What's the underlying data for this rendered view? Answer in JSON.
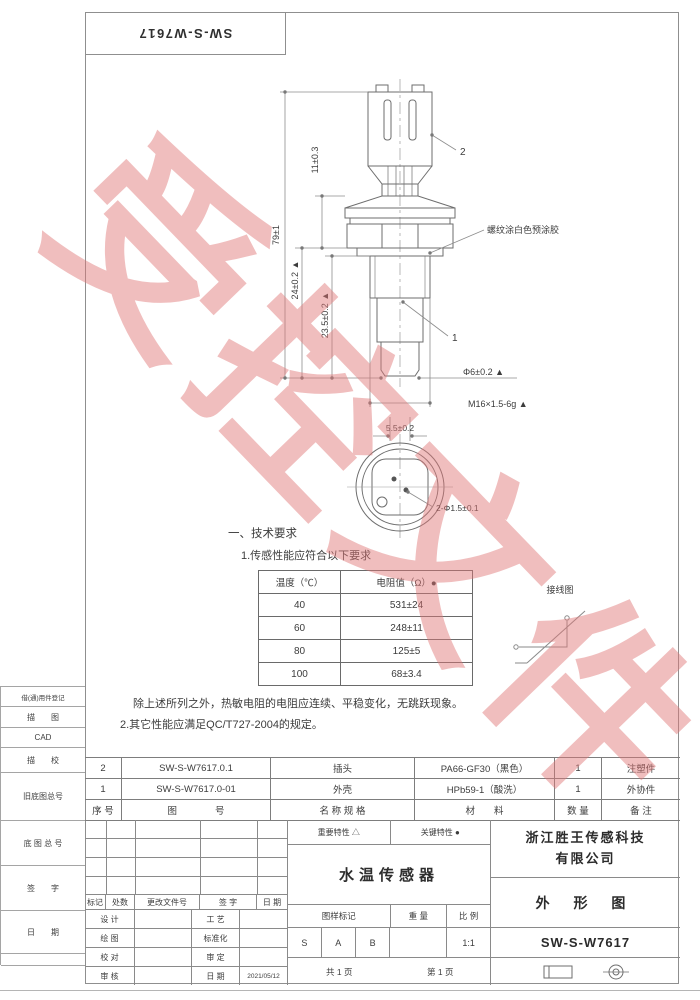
{
  "sheet": {
    "doc_number_top": "SW-S-W7617"
  },
  "watermark": {
    "text": "受控文件"
  },
  "drawing": {
    "callout_connector": "2",
    "callout_body": "1",
    "thread_note": "螺纹涂白色预涂胶",
    "wiring_label": "接线图",
    "dims": {
      "overall_length": "79±1",
      "connector_height": "11±0.3",
      "body_length": "24±0.2 ▲",
      "thread_length": "23.5±0.2 ▲",
      "probe_diameter": "Φ6±0.2 ▲",
      "thread_spec": "M16×1.5-6g ▲",
      "tip_width": "5.5±0.2",
      "terminal_holes": "2-Φ1.5±0.1"
    }
  },
  "tech": {
    "section_title": "一、技术要求",
    "item1": "1.传感性能应符合以下要求",
    "table": {
      "col_temp": "温度（℃）",
      "col_res": "电阻值（Ω）●",
      "rows": [
        {
          "temp": "40",
          "res": "531±24"
        },
        {
          "temp": "60",
          "res": "248±11"
        },
        {
          "temp": "80",
          "res": "125±5"
        },
        {
          "temp": "100",
          "res": "68±3.4"
        }
      ]
    },
    "note": "除上述所列之外，热敏电阻的电阻应连续、平稳变化，无跳跃现象。",
    "item2": "2.其它性能应满足QC/T727-2004的规定。"
  },
  "bom": {
    "rows": [
      {
        "no": "2",
        "code": "SW-S-W7617.0.1",
        "name": "插头",
        "material": "PA66-GF30（黑色）",
        "qty": "1",
        "remark": "注塑件"
      },
      {
        "no": "1",
        "code": "SW-S-W7617.0-01",
        "name": "外壳",
        "material": "HPb59-1（酸洗）",
        "qty": "1",
        "remark": "外协件"
      }
    ],
    "header": {
      "no": "序 号",
      "code": "图　　　　号",
      "name": "名 称 规 格",
      "material": "材　　料",
      "qty": "数 量",
      "remark": "备 注"
    }
  },
  "titleblock": {
    "rev_header": {
      "mark": "标记",
      "count": "处数",
      "doc": "更改文件号",
      "sign": "签  字",
      "date": "日 期"
    },
    "sign_rows": [
      {
        "l": "设  计",
        "r": "工  艺"
      },
      {
        "l": "绘  图",
        "r": "标准化"
      },
      {
        "l": "校  对",
        "r": "审  定"
      },
      {
        "l": "审  核",
        "r": "日  期",
        "rv": "2021/05/12"
      }
    ],
    "important": "重要特性  △",
    "key": "关键特性  ●",
    "product_name": "水温传感器",
    "mark_label": "图样标记",
    "weight_label": "重 量",
    "scale_label": "比 例",
    "mark_s": "S",
    "mark_a": "A",
    "mark_b": "B",
    "scale_value": "1:1",
    "sheet_total": "共  1  页",
    "sheet_page": "第  1  页",
    "company_line1": "浙江胜王传感科技",
    "company_line2": "有限公司",
    "view_type": "外 形 图",
    "drawing_number": "SW-S-W7617"
  },
  "margin": {
    "labels": [
      "借(通)用件登记",
      "描　　图",
      "CAD",
      "描　　校",
      "旧底图总号",
      "底 图 总 号",
      "签　　字",
      "日　　期"
    ]
  }
}
